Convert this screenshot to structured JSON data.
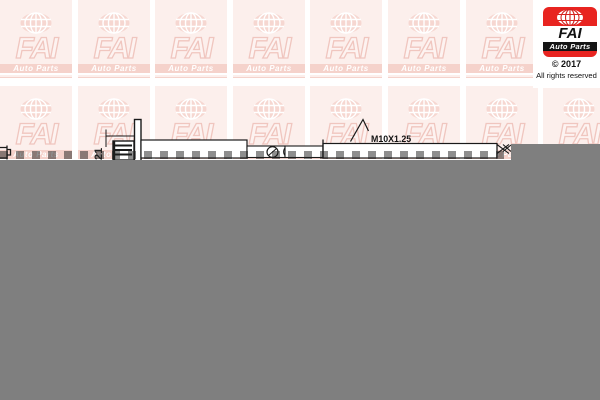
{
  "page": {
    "background": "#ffffff",
    "viewer_gray": "#7f7f7f"
  },
  "watermark": {
    "brand": "FAI",
    "sub": "Auto Parts",
    "tile_bg": "#fcefec",
    "accent_pink": "#f5d2cb",
    "grid": {
      "columns": 8,
      "rows": 2,
      "pitch_x": 77.6,
      "pitch_y": 86,
      "skip_col": 7,
      "skip_row": 0
    }
  },
  "logo": {
    "brand": "FAI",
    "sub": "Auto Parts",
    "copyright": "© 2017",
    "rights": "All rights reserved",
    "red": "#e82420",
    "black_band": "#151515"
  },
  "drawing": {
    "dimension_label": "21",
    "thread_label": "M10X1.25",
    "line_color": "#1a1a1a"
  }
}
